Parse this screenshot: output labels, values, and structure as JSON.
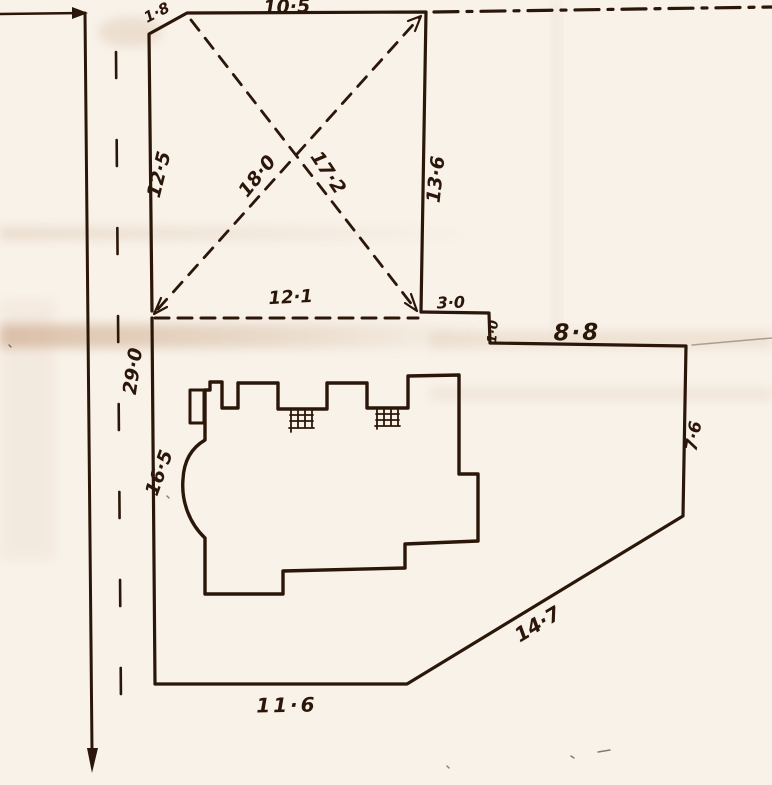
{
  "labels": {
    "corner_cut": "1·8",
    "top_width": "10·5",
    "upper_left_side": "12·5",
    "diagonal_main": "18·0",
    "diagonal_cross": "17·2",
    "upper_right_side": "13·6",
    "upper_bottom": "12·1",
    "offset_3_0": "3·0",
    "step_1_0": "1·0",
    "north_boundary": "8·8",
    "road_side": "29·0",
    "building_setback": "16·5",
    "east_side": "7·6",
    "splay_side": "14·7",
    "south_side": "11·6"
  },
  "colors": {
    "ink": "#2b1709",
    "paper": "#f8f2e9",
    "crease": "#c49a78"
  }
}
